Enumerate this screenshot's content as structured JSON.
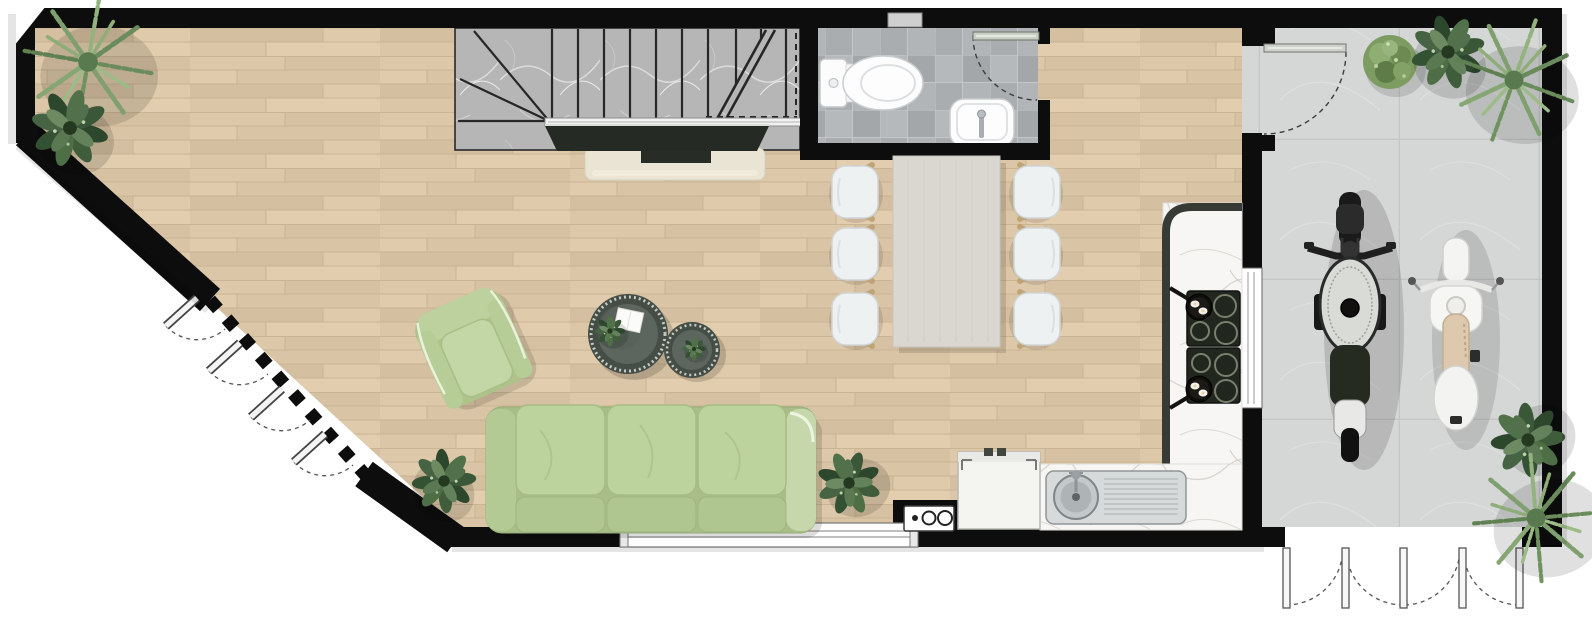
{
  "page": {
    "kind": "architectural floor plan, top-down 2D render",
    "background": "#ffffff",
    "no_visible_text": true
  },
  "palette": {
    "wall": "#0d0d0d",
    "wood": "#dcc7a8",
    "plank_line": "#c9b493",
    "marble": "#b6b6b6",
    "tile_a": "#a3a7aa",
    "tile_b": "#b6b9bb",
    "garage": "#d5d7d6",
    "counter": "#f7f6f4",
    "sofa": "#bdd39e",
    "sofa_dark": "#a9bd89",
    "seat": "#eef1f2",
    "chair_wood": "#bfa478",
    "table": "#d9d7cf",
    "console": "#eae4d4",
    "tv": "#252b24",
    "cooktop": "#21261f",
    "steel": "#d7dadb",
    "moto": "#1a1a1a",
    "scooter": "#f4f4f2",
    "scooter_seat": "#dcc9ae",
    "plant_dark": "#2d472d",
    "plant_mid": "#4e6e46",
    "palm": "#7fa06e",
    "line": "#272727"
  },
  "rooms": [
    {
      "name": "living-room",
      "floor": "light-oak-plank"
    },
    {
      "name": "dining-area",
      "floor": "light-oak-plank"
    },
    {
      "name": "kitchen",
      "floor": "light-oak-plank"
    },
    {
      "name": "bathroom",
      "floor": "gray-checker-tile",
      "fixtures": [
        "toilet",
        "hand-basin"
      ]
    },
    {
      "name": "staircase",
      "treads": "gray-marble",
      "features": [
        "winder-steps",
        "break-line",
        "handrail"
      ]
    },
    {
      "name": "garage",
      "floor": "large-gray-tile"
    }
  ],
  "furniture": {
    "sofa": {
      "seats": 3,
      "color": "sage-green"
    },
    "armchair": {
      "count": 1,
      "color": "sage-green"
    },
    "coffee_tables": {
      "count": 2,
      "shape": "round",
      "items_on_top": [
        "small-plant",
        "small-plant",
        "white-book"
      ]
    },
    "dining_table": {
      "shape": "rectangular",
      "chairs": 6
    },
    "tv": {
      "type": "flat-screen",
      "on": "media-console"
    },
    "kitchen": {
      "cooktop_modules": 2,
      "burners": 8,
      "frying_pans": 2,
      "sink": "single-round-bowl-with-drainboard",
      "appliance": "under-counter-unit"
    },
    "vehicles": [
      "black-motorcycle",
      "white-scooter"
    ],
    "plants_total": 11
  },
  "openings": {
    "bathroom_swing_door": 1,
    "garage_side_sliding_door": 1,
    "angled_glass_wall_door_leaves": 4,
    "garage_folding_door_leaves": 5,
    "windows": [
      "living-room-south-window",
      "kitchen-east-window",
      "bathroom-top-niche"
    ]
  }
}
